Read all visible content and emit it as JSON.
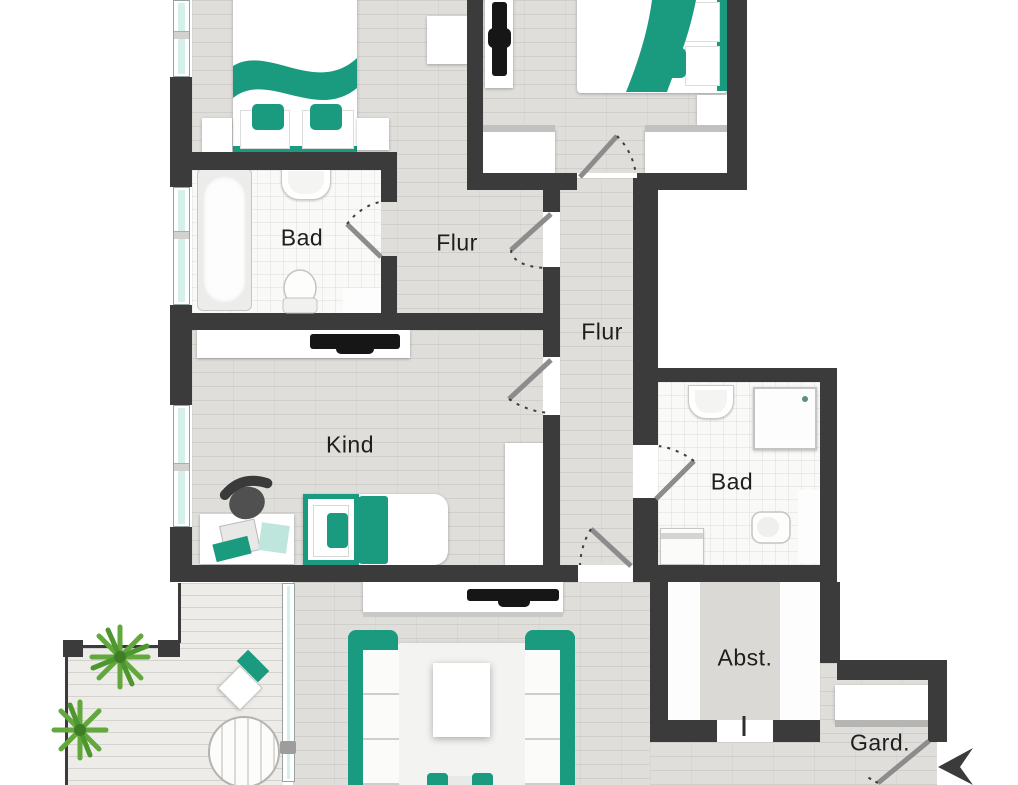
{
  "title": "Apartment floor plan (Wohnungsgrundriss)",
  "labels": {
    "bathroom_left": "Bad",
    "hall_upper": "Flur",
    "hall_lower": "Flur",
    "child_room": "Kind",
    "bathroom_right": "Bad",
    "storage": "Abst.",
    "wardrobe_area": "Gard."
  },
  "colors": {
    "accent": "#1a9b80",
    "wall": "#3b3b3b",
    "floor": "#dfdedb",
    "tile": "#f9f9f8",
    "deck": "#edece9",
    "glass": "#d5f0ea",
    "plant": "#63a83c",
    "label": "#1e1e1e"
  }
}
